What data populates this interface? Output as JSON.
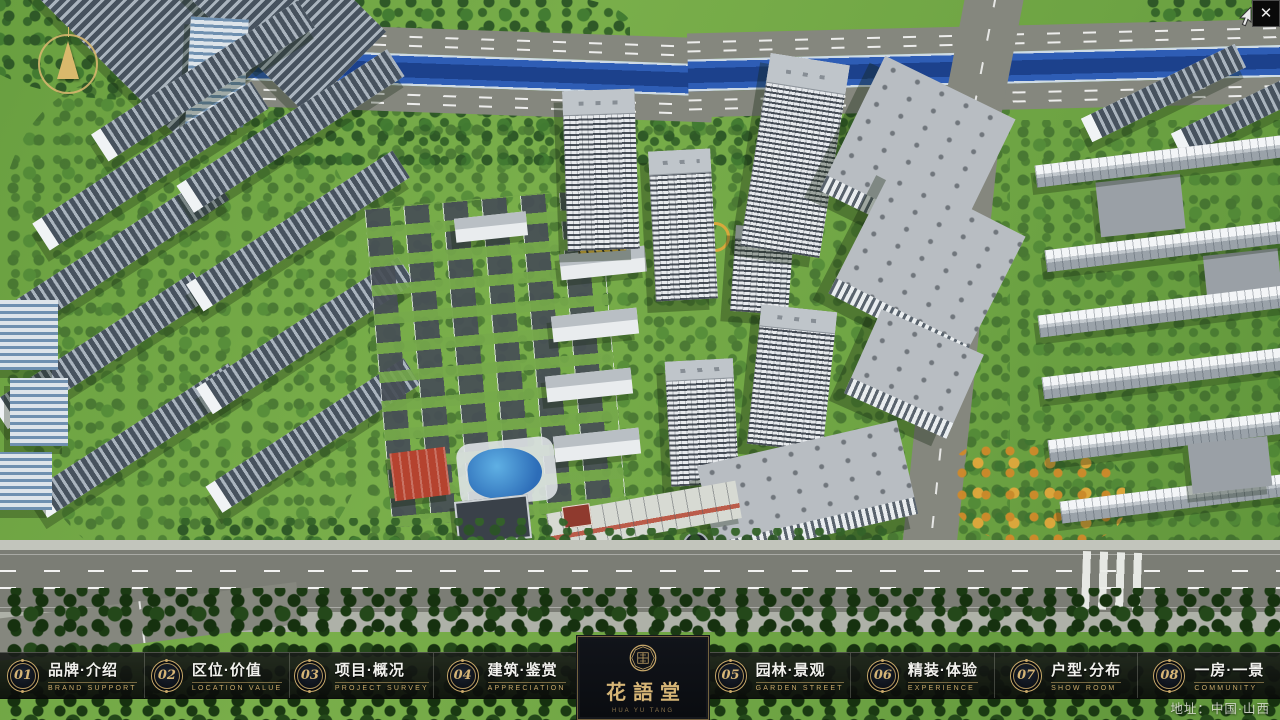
{
  "app": {
    "close_glyph": "✕"
  },
  "logo": {
    "name": "花語堂",
    "subtitle": "HUA YU TANG"
  },
  "nav": [
    {
      "num": "01",
      "title": "品牌·介绍",
      "subtitle": "BRAND SUPPORT"
    },
    {
      "num": "02",
      "title": "区位·价值",
      "subtitle": "LOCATION VALUE"
    },
    {
      "num": "03",
      "title": "项目·概况",
      "subtitle": "PROJECT SURVEY"
    },
    {
      "num": "04",
      "title": "建筑·鉴赏",
      "subtitle": "APPRECIATION"
    },
    {
      "num": "05",
      "title": "园林·景观",
      "subtitle": "GARDEN STREET"
    },
    {
      "num": "06",
      "title": "精装·体验",
      "subtitle": "EXPERIENCE"
    },
    {
      "num": "07",
      "title": "户型·分布",
      "subtitle": "SHOW ROOM"
    },
    {
      "num": "08",
      "title": "一房·一景",
      "subtitle": "COMMUNITY"
    }
  ],
  "footer": {
    "address": "地址：中国·山西"
  },
  "colors": {
    "gold": "#c9a96a",
    "bar_bg": "#0c0e0c",
    "river": "#2e5db5",
    "grass": "#74a83e"
  }
}
